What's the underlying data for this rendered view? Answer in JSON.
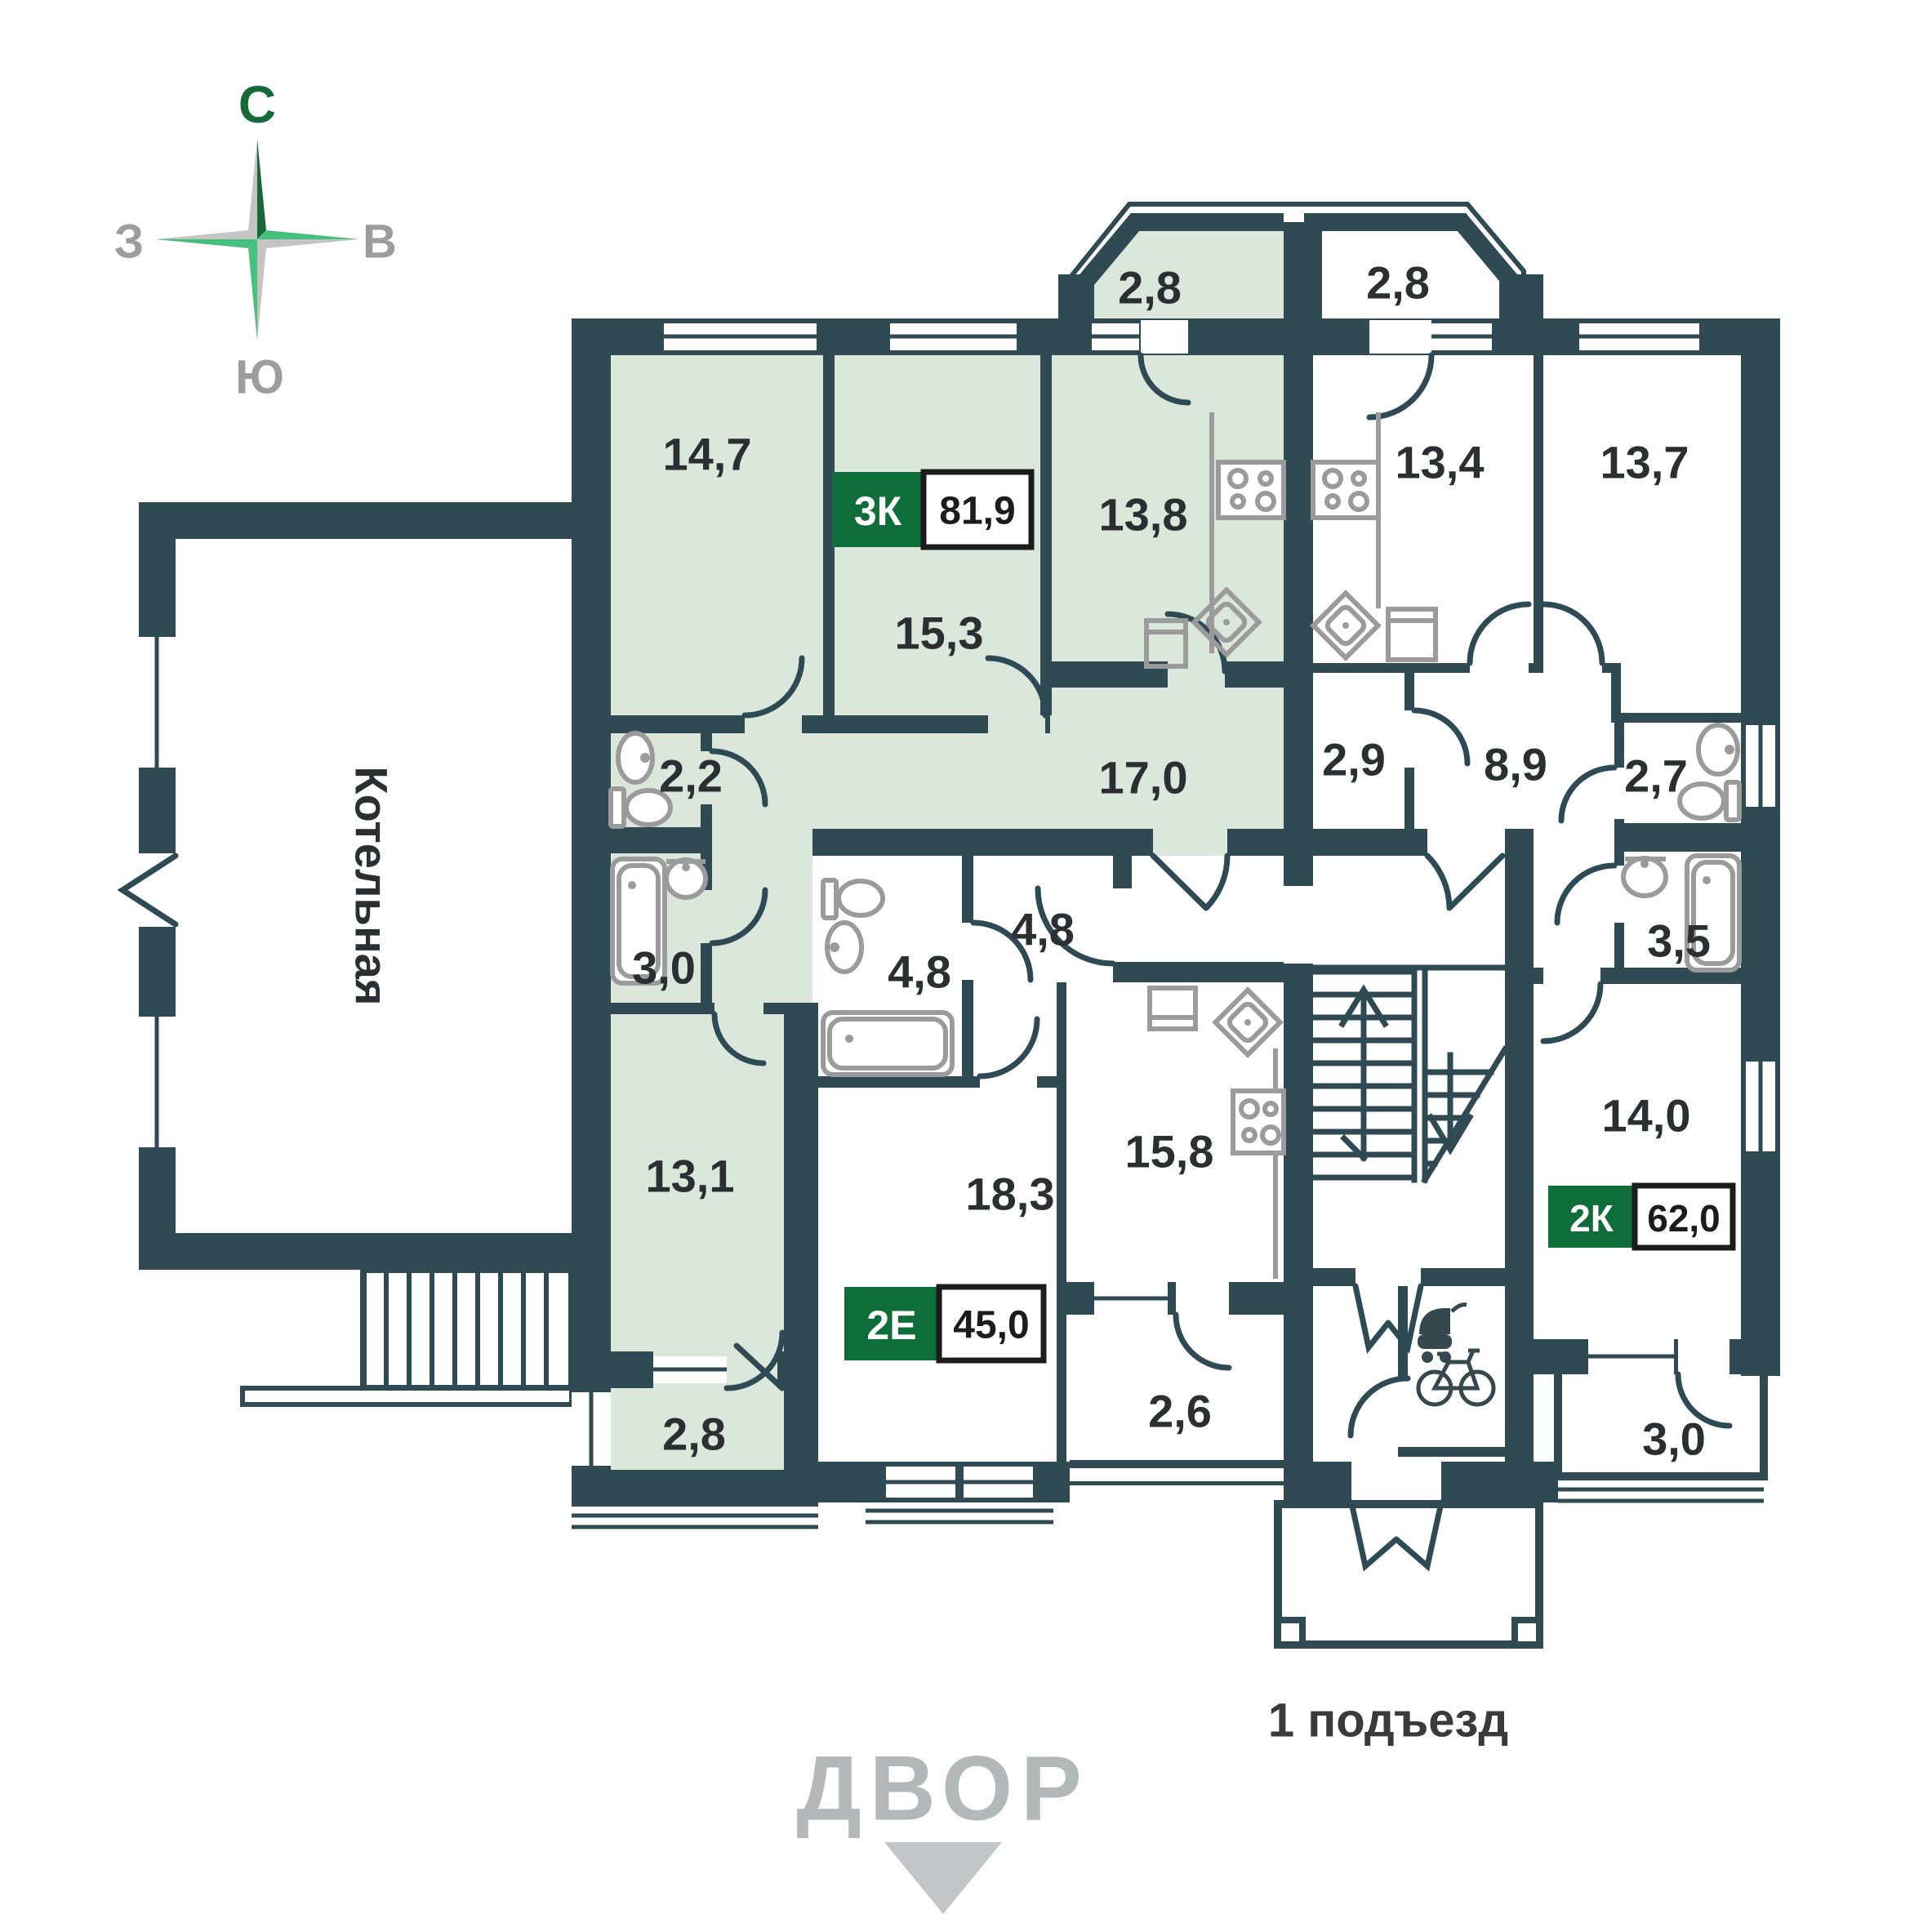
{
  "page": {
    "title": "План 1 этажа"
  },
  "colors": {
    "wall": "#304A53",
    "room_green": "#DAE7DA",
    "room_white": "#FFFFFF",
    "badge_green": "#0E6D39",
    "fixture_gray": "#9B9B9B",
    "label_dark": "#2B2F31",
    "muted_gray": "#B4B8B8",
    "compass_dark_green": "#17693A",
    "compass_bright_green": "#45C07D",
    "compass_gray": "#C4C4C4"
  },
  "compass": {
    "north": "С",
    "east": "В",
    "south": "Ю",
    "west": "З"
  },
  "boiler_room": {
    "label": "Котельная"
  },
  "apartments": [
    {
      "code": "3К",
      "total_area": "81,9",
      "rooms": [
        {
          "name": "balcony-top",
          "area": "2,8"
        },
        {
          "name": "bedroom-1",
          "area": "14,7"
        },
        {
          "name": "bedroom-2",
          "area": "15,3"
        },
        {
          "name": "kitchen",
          "area": "13,8"
        },
        {
          "name": "hall",
          "area": "17,0"
        },
        {
          "name": "wc",
          "area": "2,2"
        },
        {
          "name": "bathroom",
          "area": "3,0"
        },
        {
          "name": "living",
          "area": "13,1"
        },
        {
          "name": "balcony-bottom",
          "area": "2,8"
        }
      ]
    },
    {
      "code": "2Е",
      "total_area": "45,0",
      "rooms": [
        {
          "name": "bathroom",
          "area": "4,8"
        },
        {
          "name": "hall",
          "area": "4,8"
        },
        {
          "name": "living",
          "area": "18,3"
        },
        {
          "name": "kitchen",
          "area": "15,8"
        },
        {
          "name": "balcony",
          "area": "2,6"
        }
      ]
    },
    {
      "code": "2К",
      "total_area": "62,0",
      "rooms": [
        {
          "name": "balcony-top",
          "area": "2,8"
        },
        {
          "name": "kitchen",
          "area": "13,4"
        },
        {
          "name": "living",
          "area": "13,7"
        },
        {
          "name": "hall",
          "area": "2,9"
        },
        {
          "name": "corridor",
          "area": "8,9"
        },
        {
          "name": "wc",
          "area": "2,7"
        },
        {
          "name": "bathroom",
          "area": "3,5"
        },
        {
          "name": "bedroom",
          "area": "14,0"
        },
        {
          "name": "balcony-bottom",
          "area": "3,0"
        }
      ]
    }
  ],
  "entrance": {
    "label": "1 подъезд"
  },
  "courtyard": {
    "label": "ДВОР"
  }
}
